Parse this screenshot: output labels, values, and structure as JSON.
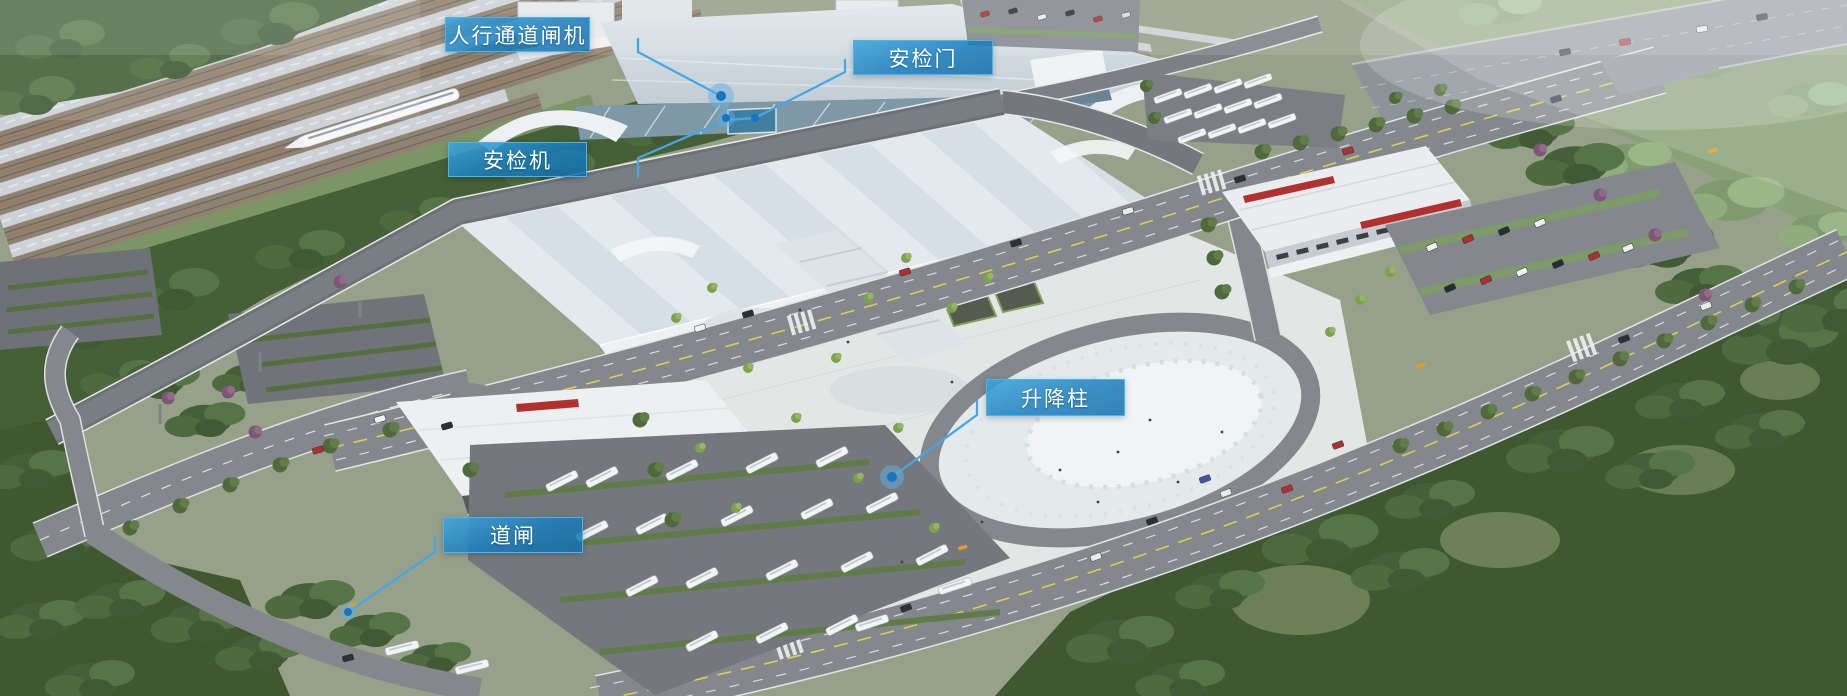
{
  "callouts": [
    {
      "id": "pedestrian-gate-machine",
      "label": "人行通道闸机"
    },
    {
      "id": "security-check-door",
      "label": "安检门"
    },
    {
      "id": "security-check-scanner",
      "label": "安检机"
    },
    {
      "id": "lifting-bollard",
      "label": "升降柱"
    },
    {
      "id": "road-barrier-gate",
      "label": "道闸"
    }
  ],
  "colors": {
    "label_fill": "#1d86c4",
    "label_border": "#49b5ec",
    "label_text": "#ffffff",
    "leader_line": "#46a7e3",
    "marker_dot": "#1674c5",
    "marker_halo": "#5fb0e4"
  }
}
